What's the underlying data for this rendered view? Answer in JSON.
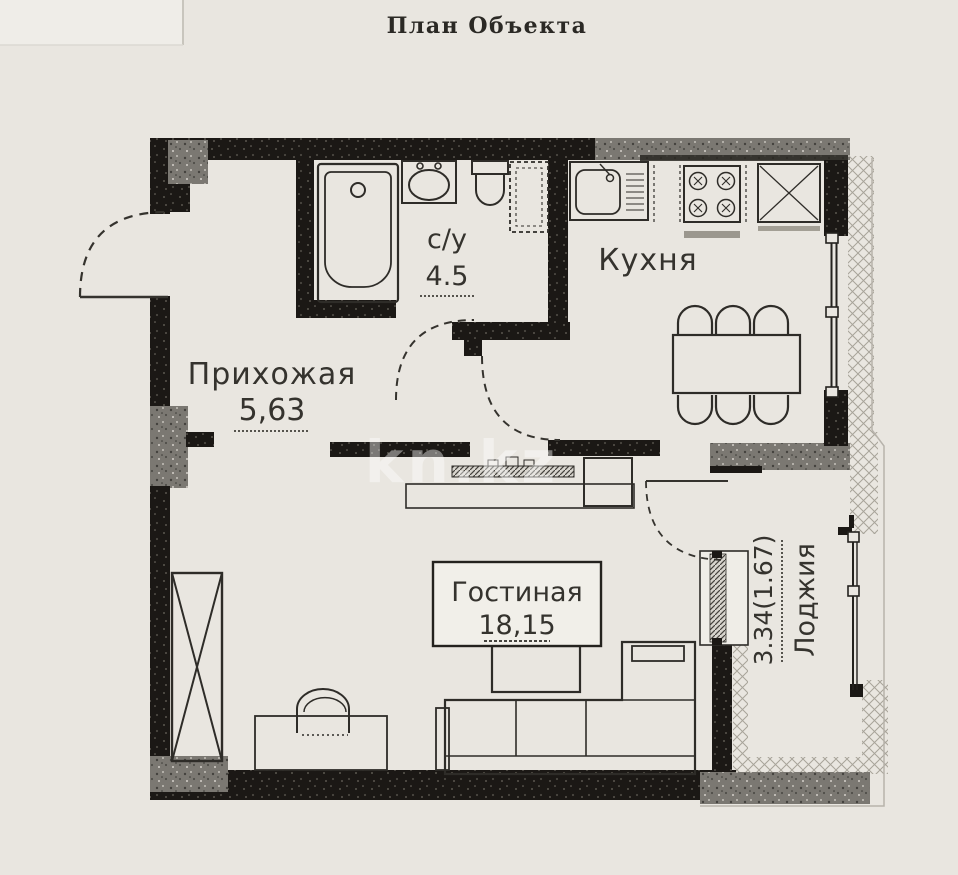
{
  "title": "План Объекта",
  "watermark": "kn.kz",
  "rooms": {
    "hallway": {
      "name": "Прихожая",
      "area": "5,63"
    },
    "bathroom": {
      "name": "с/у",
      "area": "4.5"
    },
    "kitchen": {
      "name": "Кухня",
      "area": ""
    },
    "living": {
      "name": "Гостиная",
      "area": "18,15"
    },
    "loggia": {
      "name": "Лоджия",
      "area": "3.34(1.67)"
    }
  },
  "colors": {
    "paper": "#e9e6e0",
    "wall": "#1b1815",
    "concrete": "#7b7872",
    "line": "#2e2c28"
  }
}
